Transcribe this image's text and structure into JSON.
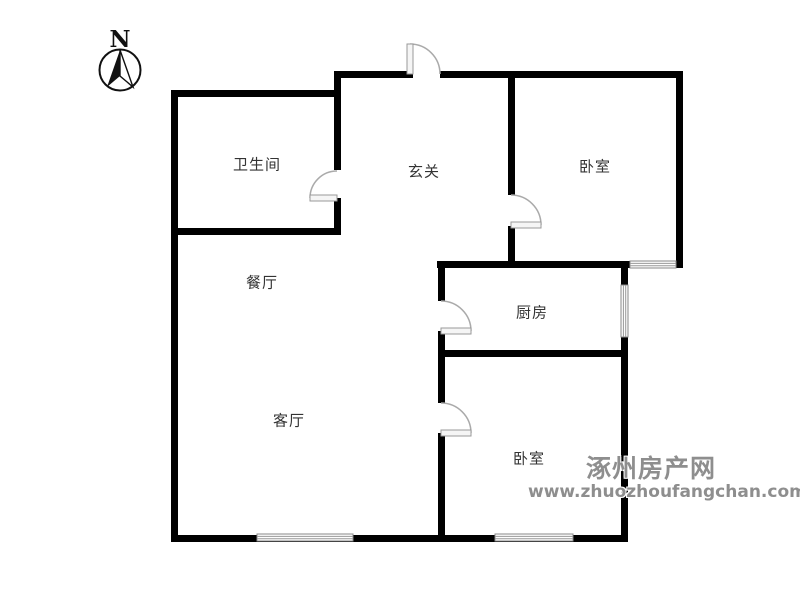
{
  "compass": {
    "label": "N"
  },
  "rooms": [
    {
      "name": "bathroom",
      "label": "卫生间"
    },
    {
      "name": "entry-hall",
      "label": "玄关"
    },
    {
      "name": "bedroom-north",
      "label": "卧室"
    },
    {
      "name": "dining-room",
      "label": "餐厅"
    },
    {
      "name": "kitchen",
      "label": "厨房"
    },
    {
      "name": "living-room",
      "label": "客厅"
    },
    {
      "name": "bedroom-south",
      "label": "卧室"
    }
  ],
  "watermark": {
    "site_name": "涿州房产网",
    "site_url": "www.zhuozhoufangchan.com",
    "color": "#8e8e8e"
  },
  "colors": {
    "wall": "#000000",
    "door_arc": "#aaaaaa",
    "door_leaf_fill": "#f5f5f5",
    "window_frame": "#888888",
    "label_text": "#333333"
  }
}
